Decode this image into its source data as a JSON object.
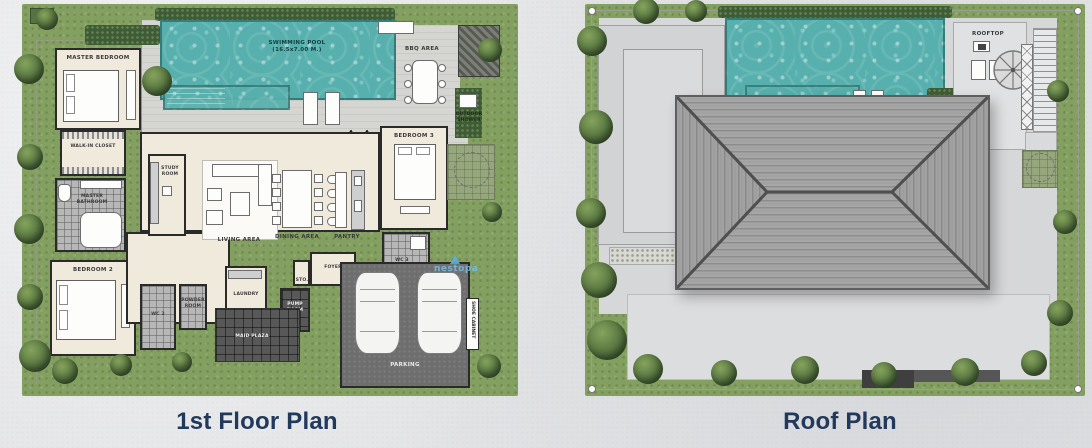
{
  "titles": {
    "floor": "1st Floor Plan",
    "roof": "Roof Plan"
  },
  "colors": {
    "title": "#21395c",
    "pool": "#57b0ad",
    "garden": "#83a061",
    "roof_ridge": "#555555",
    "watermark": "#78bee6"
  },
  "floor_plan": {
    "labels": {
      "master_bedroom": "MASTER BEDROOM",
      "walk_in_closet": "WALK-IN CLOSET",
      "master_bathroom": "MASTER BATHROOM",
      "bedroom2": "BEDROOM 2",
      "wc2": "WC 2",
      "powder_room": "POWDER ROOM",
      "study_room": "STUDY ROOM",
      "living_area": "LIVING AREA",
      "dining_area": "DINING AREA",
      "pantry": "PANTRY",
      "bedroom3": "BEDROOM 3",
      "wc3": "WC 3",
      "laundry": "LAUNDRY",
      "sto": "STO.",
      "foyer": "FOYER",
      "pump_room": "PUMP ROOM",
      "maid_plaza": "MAID PLAZA",
      "parking": "PARKING",
      "pool_deck": "POOL DECK",
      "swimming_pool": "SWIMMING POOL",
      "swimming_pool_dim": "(16.5x7.00 M.)",
      "bbq_area": "BBQ AREA",
      "outdoor_shower": "OUTDOOR SHOWER",
      "shoe_cabinet": "SHOE CABINET"
    },
    "watermark": "nestopa"
  },
  "roof_plan": {
    "labels": {
      "rooftop": "ROOFTOP"
    }
  }
}
